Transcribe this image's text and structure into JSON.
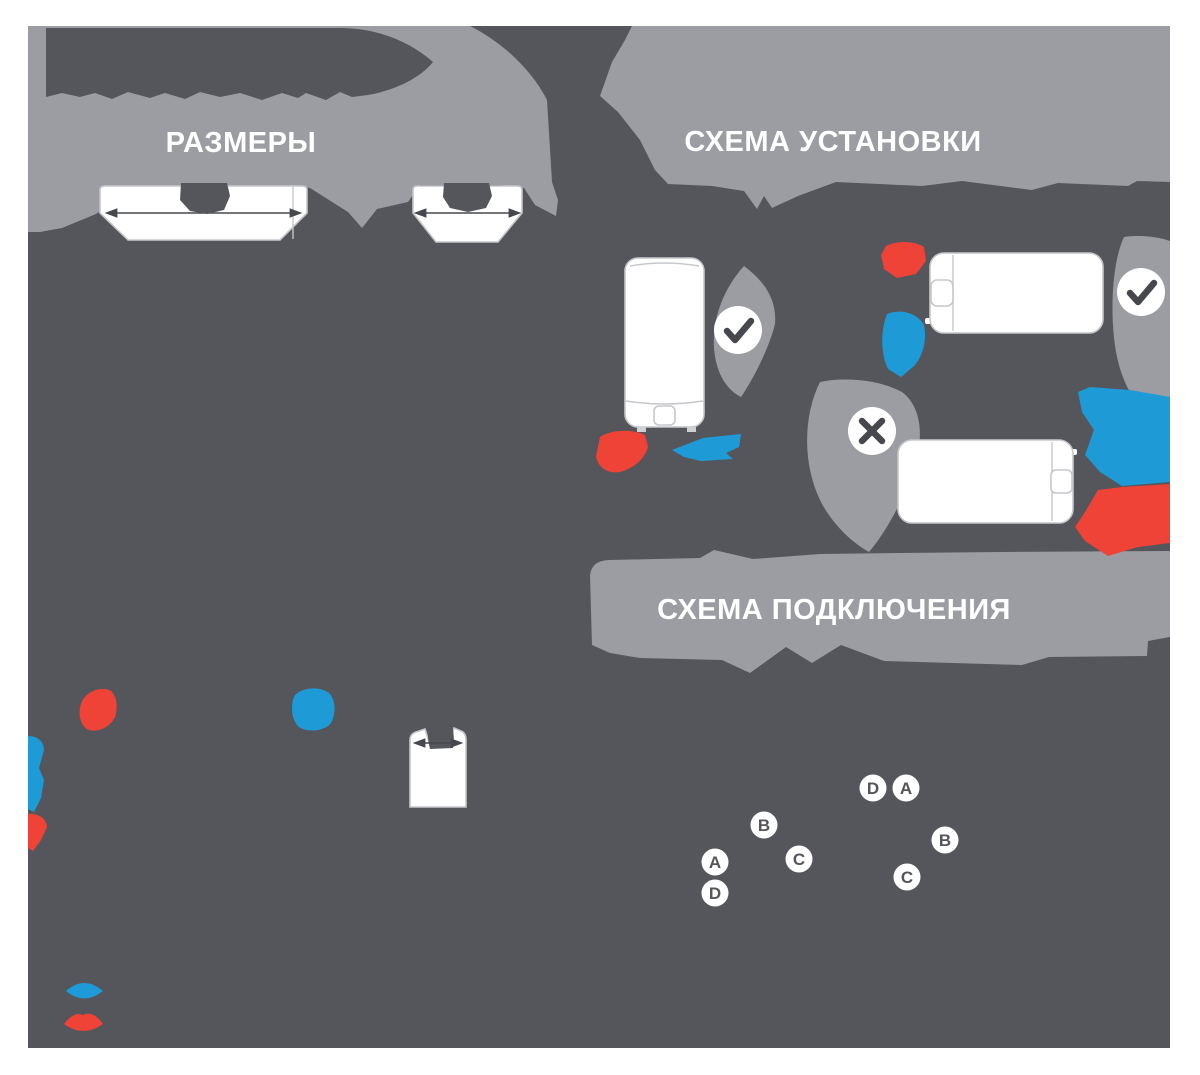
{
  "canvas": {
    "background": "#54565b",
    "blob_color": "#9b9da2",
    "page_background": "#ffffff"
  },
  "colors": {
    "hot_water": "#ee4336",
    "cold_water": "#1e9bd7",
    "icon_dark": "#46484d",
    "white": "#ffffff",
    "badge_text": "#54565b"
  },
  "sections": {
    "dimensions": {
      "title": "РАЗМЕРЫ"
    },
    "installation": {
      "title": "СХЕМА УСТАНОВКИ"
    },
    "connection": {
      "title": "СХЕМА ПОДКЛЮЧЕНИЯ"
    }
  },
  "badges": [
    "D",
    "A",
    "B",
    "C",
    "A",
    "D",
    "B",
    "C"
  ],
  "icons": {
    "allowed": "check-icon",
    "forbidden": "cross-icon",
    "hot": "hot-water-icon",
    "cold": "cold-water-icon"
  }
}
